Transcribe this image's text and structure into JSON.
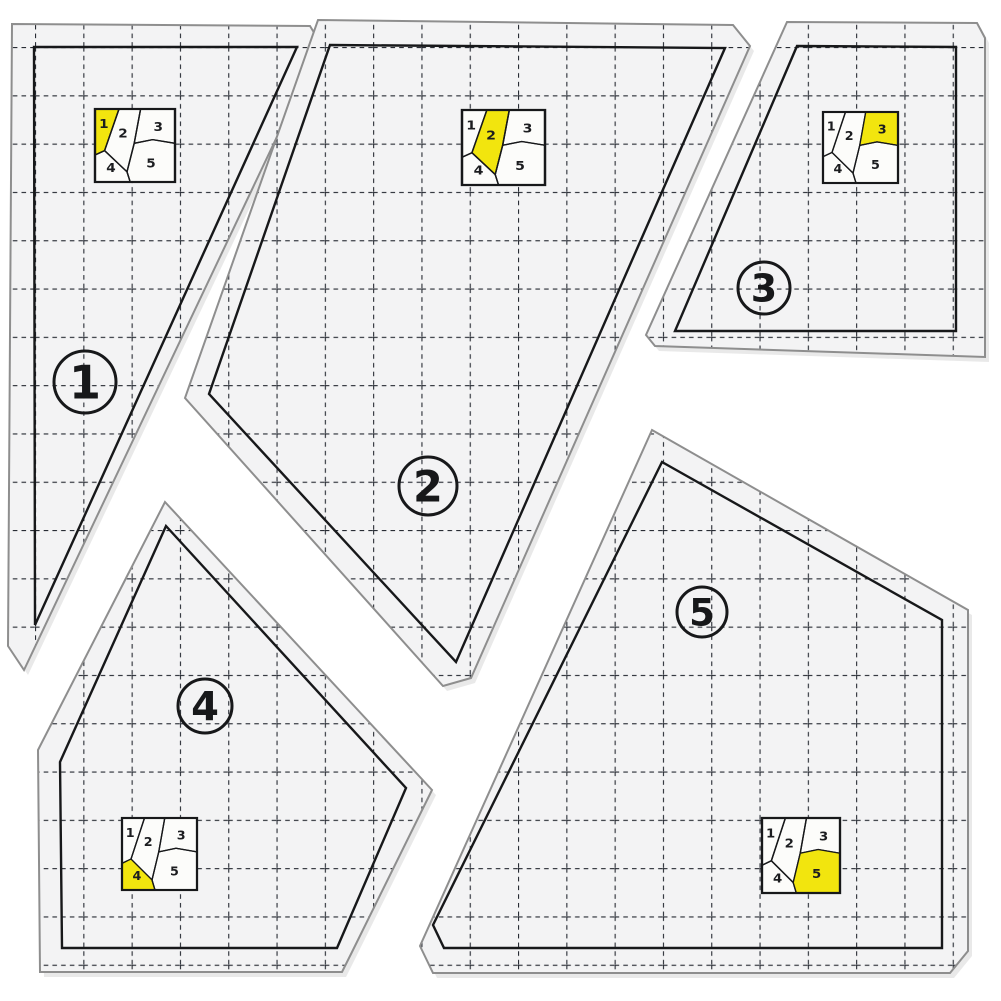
{
  "product": {
    "kind": "acrylic-quilting-template-set",
    "piece_count": 5
  },
  "colors": {
    "background": "#ffffff",
    "acrylic": "#f3f3f4",
    "shadow": "#d7d7d7",
    "edge": "#8e8e8e",
    "print": "#17181a",
    "grid_line": "#272b33",
    "inset_bg": "#fcfcfa",
    "highlight": "#f2e50e"
  },
  "grid": {
    "spacing": 48.3,
    "offset_x": 35,
    "offset_y": 47,
    "dash": "4.6 4.1",
    "stroke_width": 2.2
  },
  "pieces": [
    {
      "number": "1",
      "outer": [
        [
          12,
          24
        ],
        [
          310,
          26
        ],
        [
          321,
          44
        ],
        [
          24,
          670
        ],
        [
          8,
          646
        ]
      ],
      "inner": [
        [
          34,
          47
        ],
        [
          297,
          47
        ],
        [
          35,
          625
        ]
      ],
      "badge": {
        "cx": 85,
        "cy": 382,
        "r": 31,
        "font": 46
      },
      "inset": {
        "x": 95,
        "y": 109,
        "w": 80,
        "h": 73
      }
    },
    {
      "number": "2",
      "outer": [
        [
          318,
          20
        ],
        [
          733,
          25
        ],
        [
          750,
          46
        ],
        [
          471,
          678
        ],
        [
          443,
          686
        ],
        [
          185,
          398
        ]
      ],
      "inner": [
        [
          330,
          45
        ],
        [
          725,
          48
        ],
        [
          456,
          662
        ],
        [
          209,
          394
        ]
      ],
      "badge": {
        "cx": 428,
        "cy": 486,
        "r": 29,
        "font": 43
      },
      "inset": {
        "x": 462,
        "y": 110,
        "w": 83,
        "h": 75
      }
    },
    {
      "number": "3",
      "outer": [
        [
          787,
          22
        ],
        [
          977,
          23
        ],
        [
          985,
          38
        ],
        [
          985,
          357
        ],
        [
          655,
          346
        ],
        [
          646,
          335
        ]
      ],
      "inner": [
        [
          797,
          46
        ],
        [
          956,
          47
        ],
        [
          956,
          331
        ],
        [
          675,
          331
        ]
      ],
      "badge": {
        "cx": 764,
        "cy": 288,
        "r": 26,
        "font": 38
      },
      "inset": {
        "x": 823,
        "y": 112,
        "w": 75,
        "h": 71
      }
    },
    {
      "number": "4",
      "outer": [
        [
          165,
          502
        ],
        [
          432,
          790
        ],
        [
          352,
          952
        ],
        [
          342,
          972
        ],
        [
          40,
          972
        ],
        [
          38,
          750
        ]
      ],
      "inner": [
        [
          166,
          526
        ],
        [
          406,
          788
        ],
        [
          337,
          948
        ],
        [
          62,
          948
        ],
        [
          60,
          762
        ]
      ],
      "badge": {
        "cx": 205,
        "cy": 706,
        "r": 27,
        "font": 40
      },
      "inset": {
        "x": 122,
        "y": 818,
        "w": 75,
        "h": 72
      }
    },
    {
      "number": "5",
      "outer": [
        [
          652,
          430
        ],
        [
          968,
          610
        ],
        [
          968,
          951
        ],
        [
          950,
          973
        ],
        [
          433,
          973
        ],
        [
          420,
          946
        ]
      ],
      "inner": [
        [
          662,
          462
        ],
        [
          942,
          620
        ],
        [
          942,
          948
        ],
        [
          444,
          948
        ],
        [
          433,
          925
        ]
      ],
      "badge": {
        "cx": 702,
        "cy": 612,
        "r": 25,
        "font": 37
      },
      "inset": {
        "x": 762,
        "y": 818,
        "w": 78,
        "h": 75
      }
    }
  ],
  "inset_map": {
    "regions": [
      {
        "n": "1",
        "points": [
          [
            0,
            0
          ],
          [
            30,
            0
          ],
          [
            12,
            57
          ],
          [
            0,
            63
          ]
        ],
        "lx": 11,
        "ly": 20
      },
      {
        "n": "2",
        "points": [
          [
            30,
            0
          ],
          [
            57,
            0
          ],
          [
            49,
            47
          ],
          [
            40,
            86
          ],
          [
            12,
            57
          ]
        ],
        "lx": 35,
        "ly": 33
      },
      {
        "n": "3",
        "points": [
          [
            57,
            0
          ],
          [
            100,
            0
          ],
          [
            100,
            47
          ],
          [
            72,
            42
          ],
          [
            49,
            47
          ]
        ],
        "lx": 79,
        "ly": 24
      },
      {
        "n": "4",
        "points": [
          [
            0,
            63
          ],
          [
            12,
            57
          ],
          [
            40,
            86
          ],
          [
            44,
            100
          ],
          [
            0,
            100
          ]
        ],
        "lx": 20,
        "ly": 80
      },
      {
        "n": "5",
        "points": [
          [
            49,
            47
          ],
          [
            72,
            42
          ],
          [
            100,
            47
          ],
          [
            100,
            100
          ],
          [
            44,
            100
          ],
          [
            40,
            86
          ]
        ],
        "lx": 70,
        "ly": 74
      }
    ]
  }
}
